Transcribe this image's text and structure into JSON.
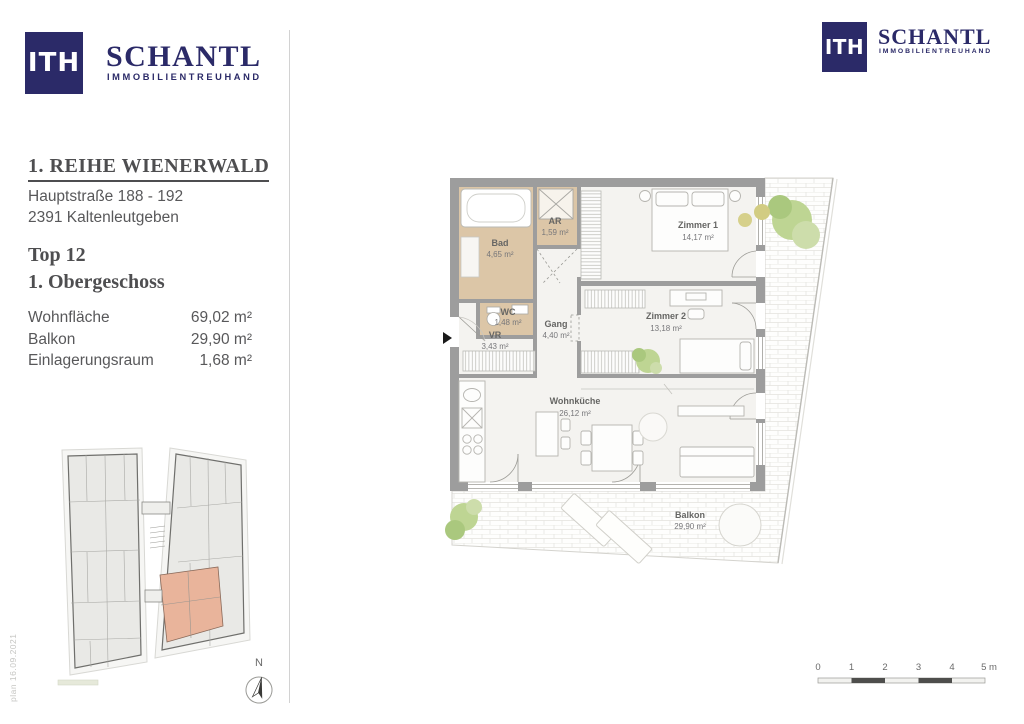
{
  "brand": {
    "mark": "ITH",
    "name": "SCHANTL",
    "tagline": "IMMOBILIENTREUHAND"
  },
  "project": {
    "title": "1. REIHE WIENERWALD",
    "address_line1": "Hauptstraße 188 - 192",
    "address_line2": "2391 Kaltenleutgeben",
    "unit": "Top 12",
    "floor": "1. Obergeschoss"
  },
  "area_summary": {
    "rows": [
      {
        "label": "Wohnfläche",
        "value": "69,02 m²"
      },
      {
        "label": "Balkon",
        "value": "29,90 m²"
      },
      {
        "label": "Einlagerungsraum",
        "value": "1,68 m²"
      }
    ]
  },
  "floor_plan": {
    "rooms": [
      {
        "name": "Bad",
        "area": "4,65 m²"
      },
      {
        "name": "AR",
        "area": "1,59 m²"
      },
      {
        "name": "Zimmer 1",
        "area": "14,17 m²"
      },
      {
        "name": "WC",
        "area": "1,48 m²"
      },
      {
        "name": "VR",
        "area": "3,43 m²"
      },
      {
        "name": "Gang",
        "area": "4,40 m²"
      },
      {
        "name": "Zimmer 2",
        "area": "13,18 m²"
      },
      {
        "name": "Wohnküche",
        "area": "26,12 m²"
      },
      {
        "name": "Balkon",
        "area": "29,90 m²"
      }
    ]
  },
  "site_plan": {
    "north_label": "N"
  },
  "scale_bar": {
    "ticks": [
      "0",
      "1",
      "2",
      "3",
      "4",
      "5 m"
    ]
  },
  "plan_date_note": "plan 16.09.2021",
  "colors": {
    "navy": "#2b2a68",
    "wall_gray": "#9d9d9d",
    "wet_room_tan": "#dcc6a7",
    "highlight_salmon": "#e9b49b",
    "plant_green": "#bed593",
    "text_gray": "#58585a"
  }
}
